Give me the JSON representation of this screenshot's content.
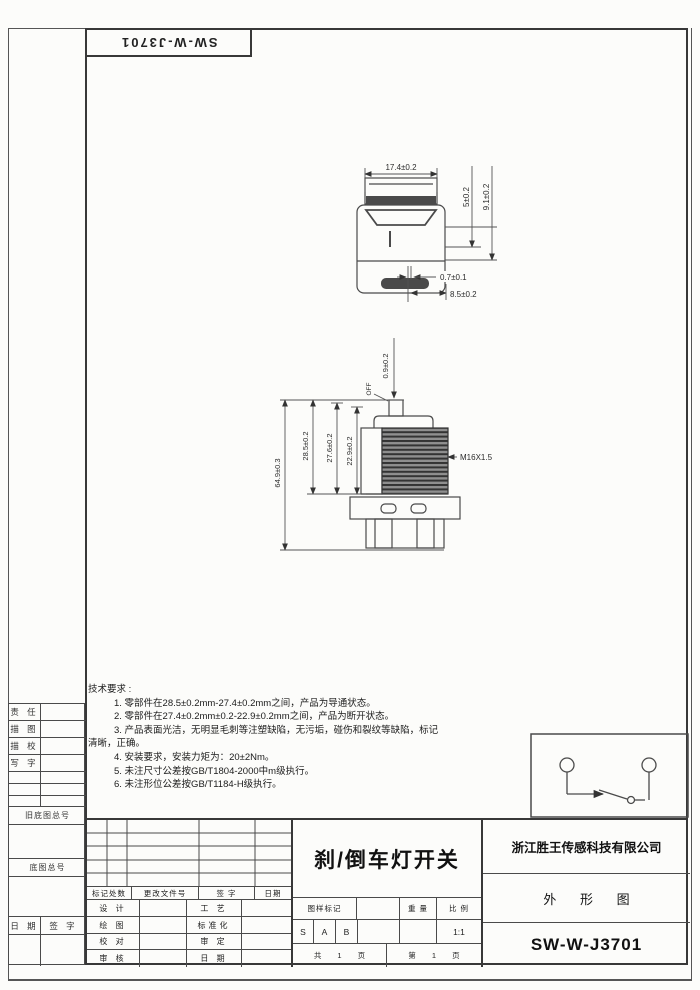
{
  "frame": {
    "part_number_top": "SW-W-J3701"
  },
  "left_margin": {
    "rows": [
      "责 任",
      "描 图",
      "描 校",
      "写 字"
    ],
    "old_base_no": "旧底图总号",
    "base_no": "底图总号",
    "date": "日 期",
    "sign": "签 字"
  },
  "top_view": {
    "dim_width": "17.4±0.2",
    "dim_h1": "5±0.2",
    "dim_h2": "9.1±0.2",
    "dim_gap": "0.7±0.1",
    "dim_pitch": "8.5±0.2"
  },
  "side_view": {
    "dim_travel": "0.9±0.2",
    "label_off": "OFF",
    "dim_total": "64.9±0.3",
    "dim_a": "28.5±0.2",
    "dim_b": "27.6±0.2",
    "dim_c": "22.9±0.2",
    "thread": "M16X1.5"
  },
  "tech": {
    "title": "技术要求 :",
    "lines": [
      "1. 零部件在28.5±0.2mm-27.4±0.2mm之间，产品为导通状态。",
      "2. 零部件在27.4±0.2mm±0.2-22.9±0.2mm之间，产品为断开状态。",
      "3. 产品表面光洁，无明显毛刺等注塑缺陷，无污垢，碰伤和裂纹等缺陷，标记",
      "清晰，正确。",
      "4. 安装要求，安装力矩为：20±2Nm。",
      "5. 未注尺寸公差按GB/T1804-2000中m级执行。",
      "6. 未注形位公差按GB/T1184-H级执行。"
    ]
  },
  "title_block": {
    "rev_header": [
      "标记处数",
      "更改文件号",
      "签 字",
      "日期"
    ],
    "sig_rows": [
      {
        "left": "设 计",
        "right": "工 艺"
      },
      {
        "left": "绘 图",
        "right": "标准化"
      },
      {
        "left": "校 对",
        "right": "审 定"
      },
      {
        "left": "审 核",
        "right": "日 期"
      }
    ],
    "product_title": "刹/倒车灯开关",
    "mark_label": "图样标记",
    "weight_label": "重 量",
    "scale_label": "比 例",
    "marks": [
      "S",
      "A",
      "B"
    ],
    "scale_value": "1:1",
    "total_pages": "共 1 页",
    "page_no": "第 1 页",
    "company": "浙江胜王传感科技有限公司",
    "doc_type": "外 形 图",
    "part_number": "SW-W-J3701"
  }
}
